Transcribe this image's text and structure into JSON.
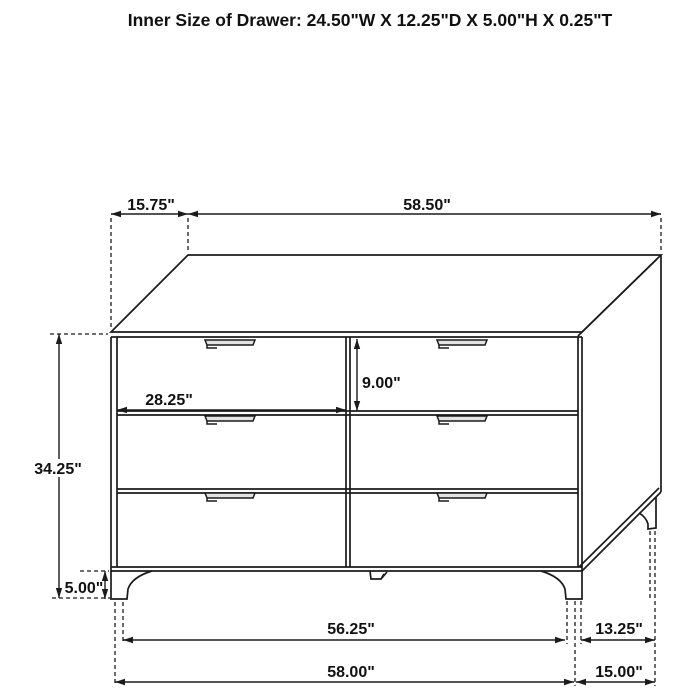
{
  "title": "Inner Size of Drawer: 24.50\"W X 12.25\"D X 5.00\"H X 0.25\"T",
  "dimensions": {
    "top_depth_offset": "15.75\"",
    "top_width": "58.50\"",
    "overall_height": "34.25\"",
    "drawer_front_width": "28.25\"",
    "drawer_front_height": "9.00\"",
    "leg_height": "5.00\"",
    "base_width_inner": "56.25\"",
    "base_depth_top": "13.25\"",
    "base_width_outer": "58.00\"",
    "base_depth_bottom": "15.00\""
  },
  "colors": {
    "line": "#1b1b1b",
    "background": "#ffffff"
  }
}
